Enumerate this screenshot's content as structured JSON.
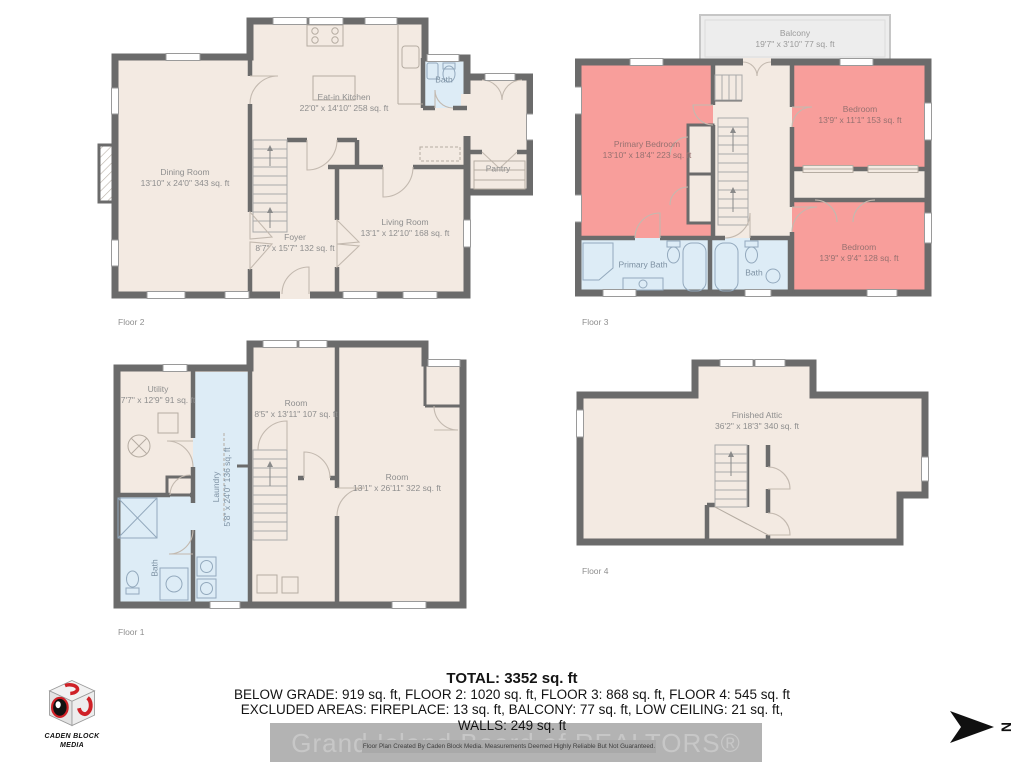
{
  "floors": {
    "floor2": {
      "caption": "Floor 2",
      "rooms": {
        "eat_in_kitchen": {
          "name": "Eat-in Kitchen",
          "dims": "22'0\" x 14'10\" 258 sq. ft"
        },
        "dining_room": {
          "name": "Dining Room",
          "dims": "13'10\" x 24'0\" 343 sq. ft"
        },
        "foyer": {
          "name": "Foyer",
          "dims": "8'7\" x 15'7\" 132 sq. ft"
        },
        "living_room": {
          "name": "Living Room",
          "dims": "13'1\" x 12'10\" 168 sq. ft"
        },
        "bath": {
          "name": "Bath"
        },
        "pantry": {
          "name": "Pantry"
        }
      }
    },
    "floor3": {
      "caption": "Floor 3",
      "rooms": {
        "balcony": {
          "name": "Balcony",
          "dims": "19'7\" x 3'10\" 77 sq. ft"
        },
        "primary_bedroom": {
          "name": "Primary Bedroom",
          "dims": "13'10\" x 18'4\" 223 sq. ft"
        },
        "bedroom_upper": {
          "name": "Bedroom",
          "dims": "13'9\" x 11'1\" 153 sq. ft"
        },
        "bedroom_lower": {
          "name": "Bedroom",
          "dims": "13'9\" x 9'4\" 128 sq. ft"
        },
        "primary_bath": {
          "name": "Primary Bath"
        },
        "bath": {
          "name": "Bath"
        }
      }
    },
    "floor1": {
      "caption": "Floor 1",
      "rooms": {
        "utility": {
          "name": "Utility",
          "dims": "7'7\" x 12'9\" 91 sq. ft"
        },
        "laundry": {
          "name": "Laundry",
          "dims": "5'8\" x 24'0\" 136 sq. ft"
        },
        "room_small": {
          "name": "Room",
          "dims": "8'5\" x 13'11\" 107 sq. ft"
        },
        "room_large": {
          "name": "Room",
          "dims": "13'1\" x 26'11\" 322 sq. ft"
        },
        "bath": {
          "name": "Bath"
        }
      }
    },
    "floor4": {
      "caption": "Floor 4",
      "rooms": {
        "finished_attic": {
          "name": "Finished Attic",
          "dims": "36'2\" x 18'3\" 340 sq. ft"
        }
      }
    }
  },
  "summary": {
    "total": "TOTAL: 3352 sq. ft",
    "line1": "BELOW GRADE: 919 sq. ft, FLOOR 2: 1020 sq. ft, FLOOR 3: 868 sq. ft, FLOOR 4: 545 sq. ft",
    "line2": "EXCLUDED AREAS: FIREPLACE: 13 sq. ft, BALCONY: 77 sq. ft, LOW CEILING: 21 sq. ft,",
    "line3": "WALLS: 249 sq. ft"
  },
  "branding": {
    "logo_name_line1": "CADEN BLOCK",
    "logo_name_line2": "MEDIA",
    "watermark": "Grand Island Board of REALTORS®",
    "disclaimer": "Floor Plan Created By Caden Block Media. Measurements Deemed Highly Reliable But Not Guaranteed.",
    "compass_letter": "N"
  },
  "colors": {
    "wall": "#6b6b6b",
    "floor_cream": "#f3eae2",
    "bedroom_pink": "#f89e9b",
    "bath_blue": "#ddecf6",
    "balcony_gray": "#ededed",
    "watermark_bar": "#b3b3b3",
    "logo_red": "#cf2127"
  }
}
